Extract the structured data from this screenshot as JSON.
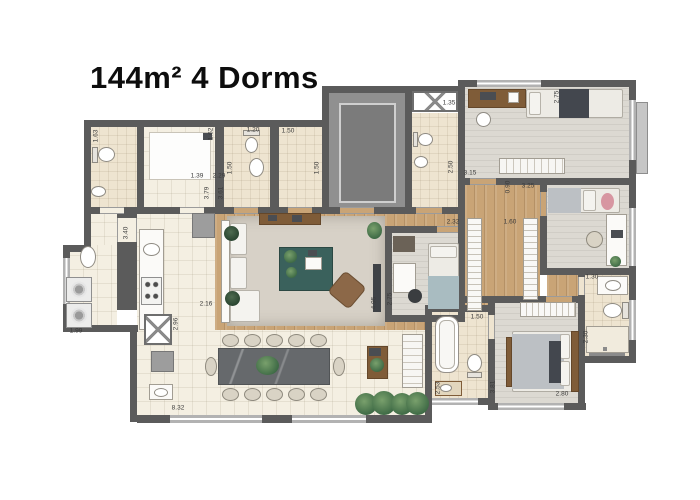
{
  "title": "144m² 4 Dorms",
  "colors": {
    "wall": "#5b5b5b",
    "wood_floor": "#c9a476",
    "tile_floor": "#f4efe2",
    "bath_floor": "#eee4d0",
    "carpet_floor": "#dcd9d2",
    "accent_table": "#3a615c",
    "dining_table": "#66696c",
    "plant": "#3f6b46"
  },
  "plan": {
    "dimension_labels": [
      {
        "text": "1.63",
        "x": 96,
        "y": 136,
        "vertical": true
      },
      {
        "text": "1.39",
        "x": 197,
        "y": 176,
        "vertical": false
      },
      {
        "text": "2.29",
        "x": 219,
        "y": 176,
        "vertical": false
      },
      {
        "text": "1.62",
        "x": 211,
        "y": 134,
        "vertical": true
      },
      {
        "text": "1.20",
        "x": 253,
        "y": 130,
        "vertical": false
      },
      {
        "text": "1.50",
        "x": 230,
        "y": 168,
        "vertical": true
      },
      {
        "text": "1.50",
        "x": 288,
        "y": 131,
        "vertical": false
      },
      {
        "text": "1.50",
        "x": 317,
        "y": 168,
        "vertical": true
      },
      {
        "text": "3.79",
        "x": 207,
        "y": 193,
        "vertical": true
      },
      {
        "text": "3.61",
        "x": 221,
        "y": 193,
        "vertical": true
      },
      {
        "text": "1.35",
        "x": 449,
        "y": 103,
        "vertical": false
      },
      {
        "text": "2.50",
        "x": 451,
        "y": 167,
        "vertical": true
      },
      {
        "text": "2.75",
        "x": 557,
        "y": 97,
        "vertical": true
      },
      {
        "text": "3.15",
        "x": 470,
        "y": 173,
        "vertical": false
      },
      {
        "text": "0.90",
        "x": 508,
        "y": 187,
        "vertical": true
      },
      {
        "text": "3.25",
        "x": 528,
        "y": 186,
        "vertical": false
      },
      {
        "text": "2.32",
        "x": 453,
        "y": 222,
        "vertical": false
      },
      {
        "text": "1.60",
        "x": 510,
        "y": 222,
        "vertical": false
      },
      {
        "text": "3.40",
        "x": 126,
        "y": 233,
        "vertical": true
      },
      {
        "text": "2.16",
        "x": 206,
        "y": 304,
        "vertical": false
      },
      {
        "text": "2.96",
        "x": 176,
        "y": 324,
        "vertical": true
      },
      {
        "text": "1.99",
        "x": 76,
        "y": 331,
        "vertical": false
      },
      {
        "text": "8.32",
        "x": 178,
        "y": 408,
        "vertical": false
      },
      {
        "text": "4.95",
        "x": 374,
        "y": 303,
        "vertical": true
      },
      {
        "text": "2.75",
        "x": 390,
        "y": 299,
        "vertical": true
      },
      {
        "text": "1.50",
        "x": 477,
        "y": 317,
        "vertical": false
      },
      {
        "text": "1.30",
        "x": 592,
        "y": 277,
        "vertical": false
      },
      {
        "text": "2.30",
        "x": 586,
        "y": 337,
        "vertical": true
      },
      {
        "text": "2.53",
        "x": 438,
        "y": 388,
        "vertical": true
      },
      {
        "text": "3.81",
        "x": 493,
        "y": 387,
        "vertical": true
      },
      {
        "text": "2.80",
        "x": 562,
        "y": 394,
        "vertical": false
      }
    ]
  }
}
